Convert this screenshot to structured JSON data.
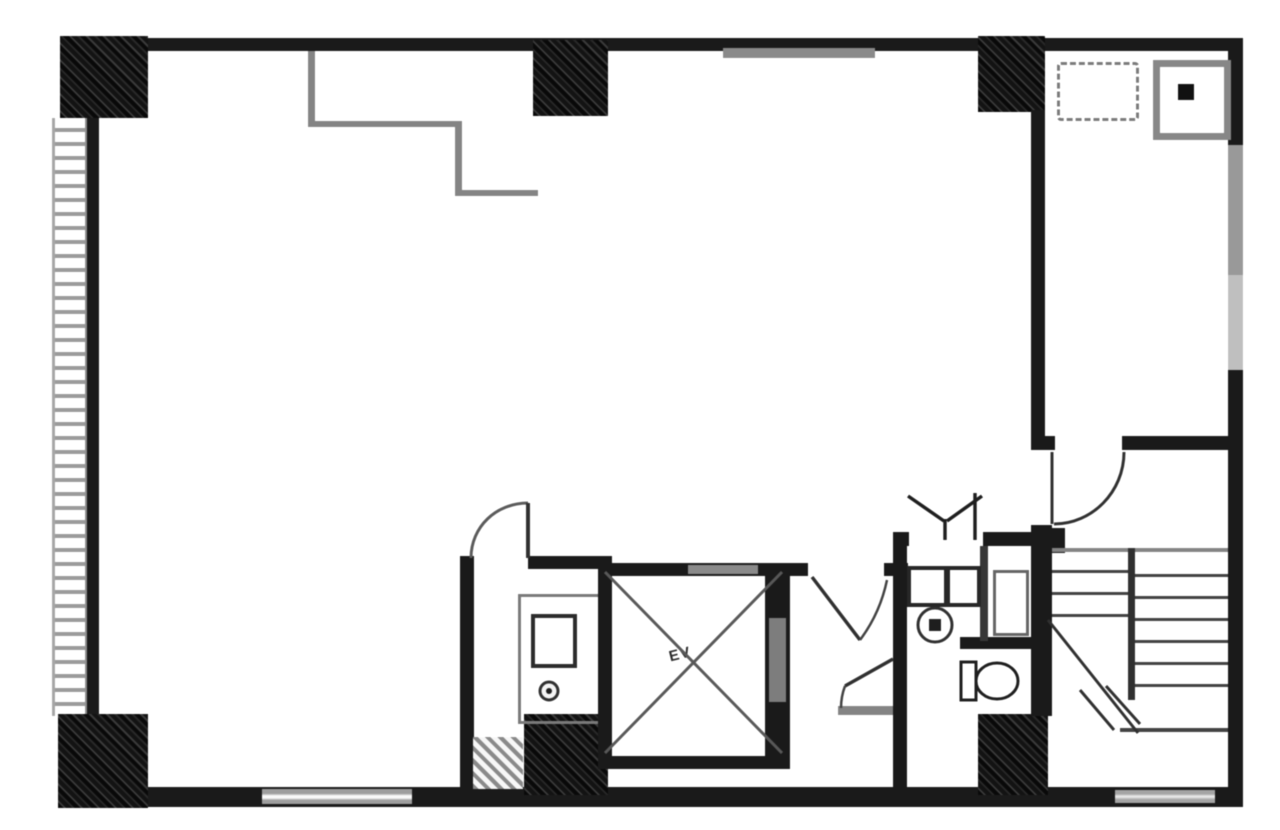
{
  "labels": {
    "elevator": "EV"
  },
  "colors": {
    "paper": "#ffffff",
    "wall": "#1e1e1e",
    "gray_line": "#848484",
    "light_window": "#aeaeae",
    "fixture_stroke": "#333333"
  }
}
